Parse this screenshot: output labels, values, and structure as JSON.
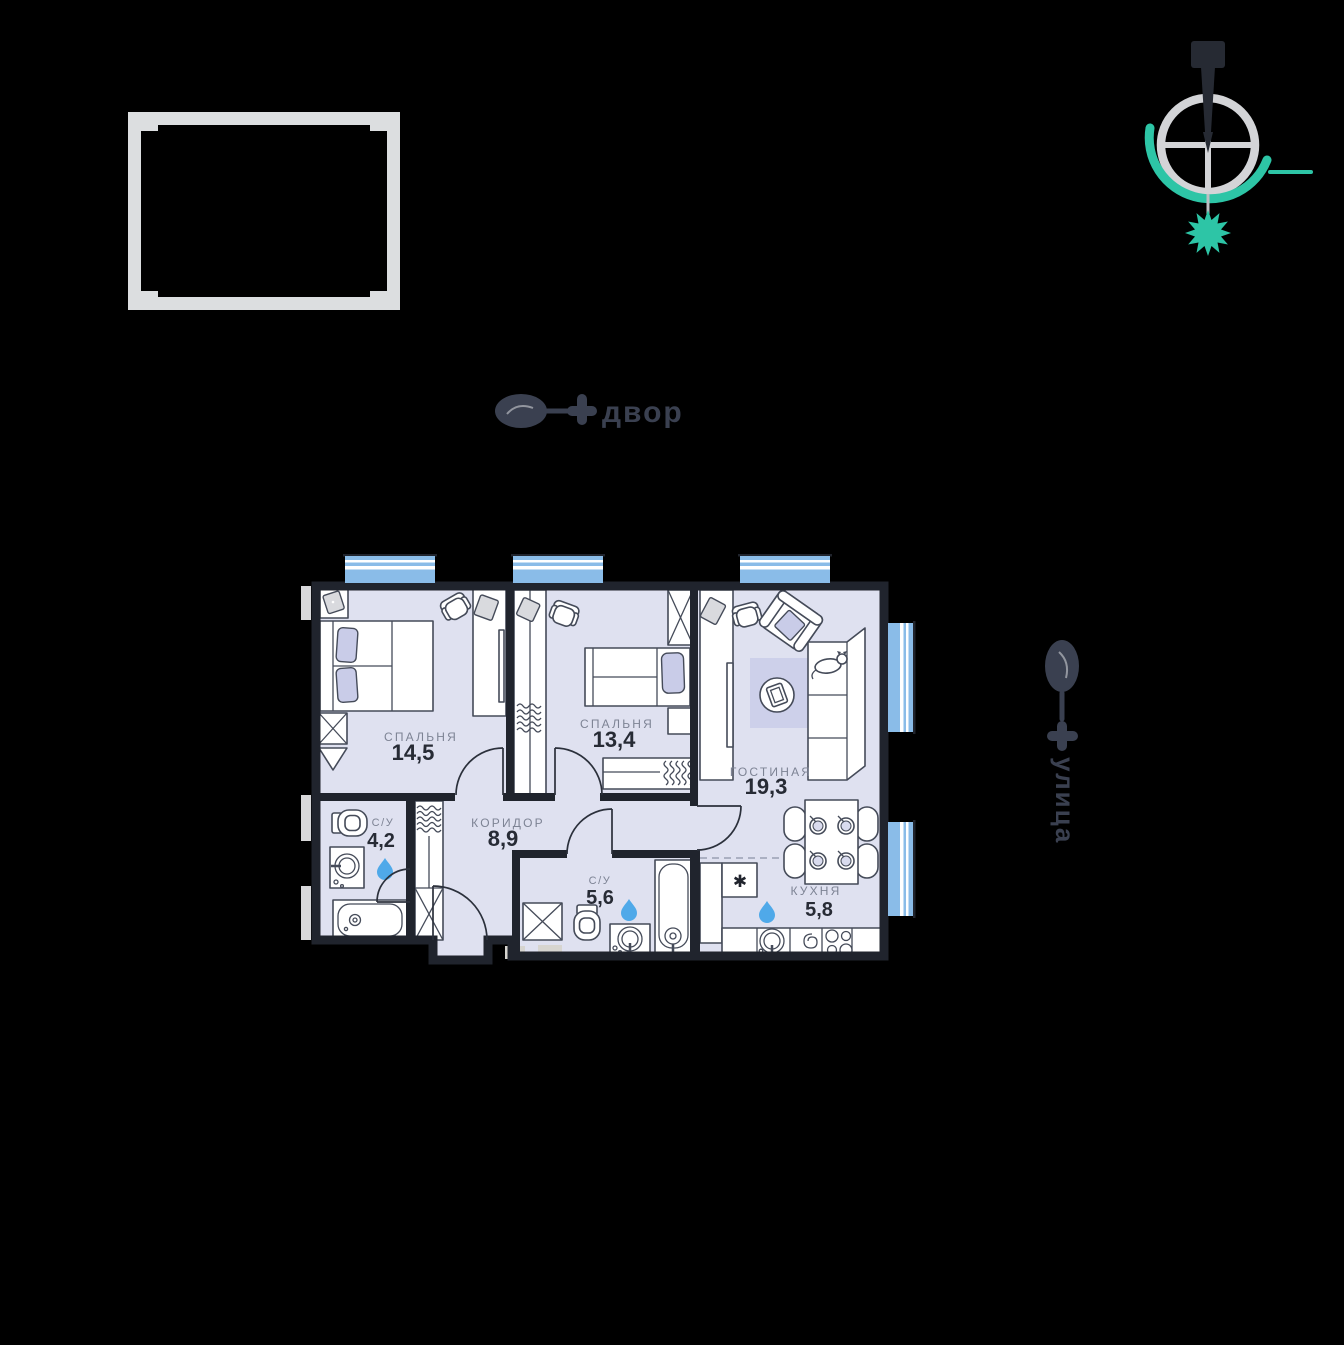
{
  "colors": {
    "background": "#000000",
    "floor": "#dfe1f0",
    "wall": "#20242d",
    "accent_lavender": "#c9cce8",
    "window_blue": "#8abce8",
    "water_drop_blue": "#4fa9e9",
    "compass_teal": "#2dc5a6",
    "compass_gray": "#d3d4d7",
    "frame_gray": "#dcdee0",
    "marker_dark": "#3a4050",
    "room_label_gray": "#7d8394",
    "area_number_dark": "#272b35"
  },
  "compass": {
    "icon": "compass-north-icon"
  },
  "orientation_markers": {
    "top": {
      "label": "двор",
      "icon": "courtyard-tree-icon"
    },
    "right": {
      "label": "улица",
      "icon": "courtyard-tree-icon"
    }
  },
  "floorplan": {
    "rooms": [
      {
        "id": "bedroom-1",
        "name": "СПАЛЬНЯ",
        "area": "14,5"
      },
      {
        "id": "bedroom-2",
        "name": "СПАЛЬНЯ",
        "area": "13,4"
      },
      {
        "id": "living-room",
        "name": "ГОСТИНАЯ",
        "area": "19,3"
      },
      {
        "id": "corridor",
        "name": "КОРИДОР",
        "area": "8,9"
      },
      {
        "id": "bathroom-1",
        "name": "С/У",
        "area": "4,2"
      },
      {
        "id": "bathroom-2",
        "name": "С/У",
        "area": "5,6"
      },
      {
        "id": "kitchen",
        "name": "КУХНЯ",
        "area": "5,8"
      }
    ],
    "symbols": {
      "fridge": "✱"
    }
  }
}
